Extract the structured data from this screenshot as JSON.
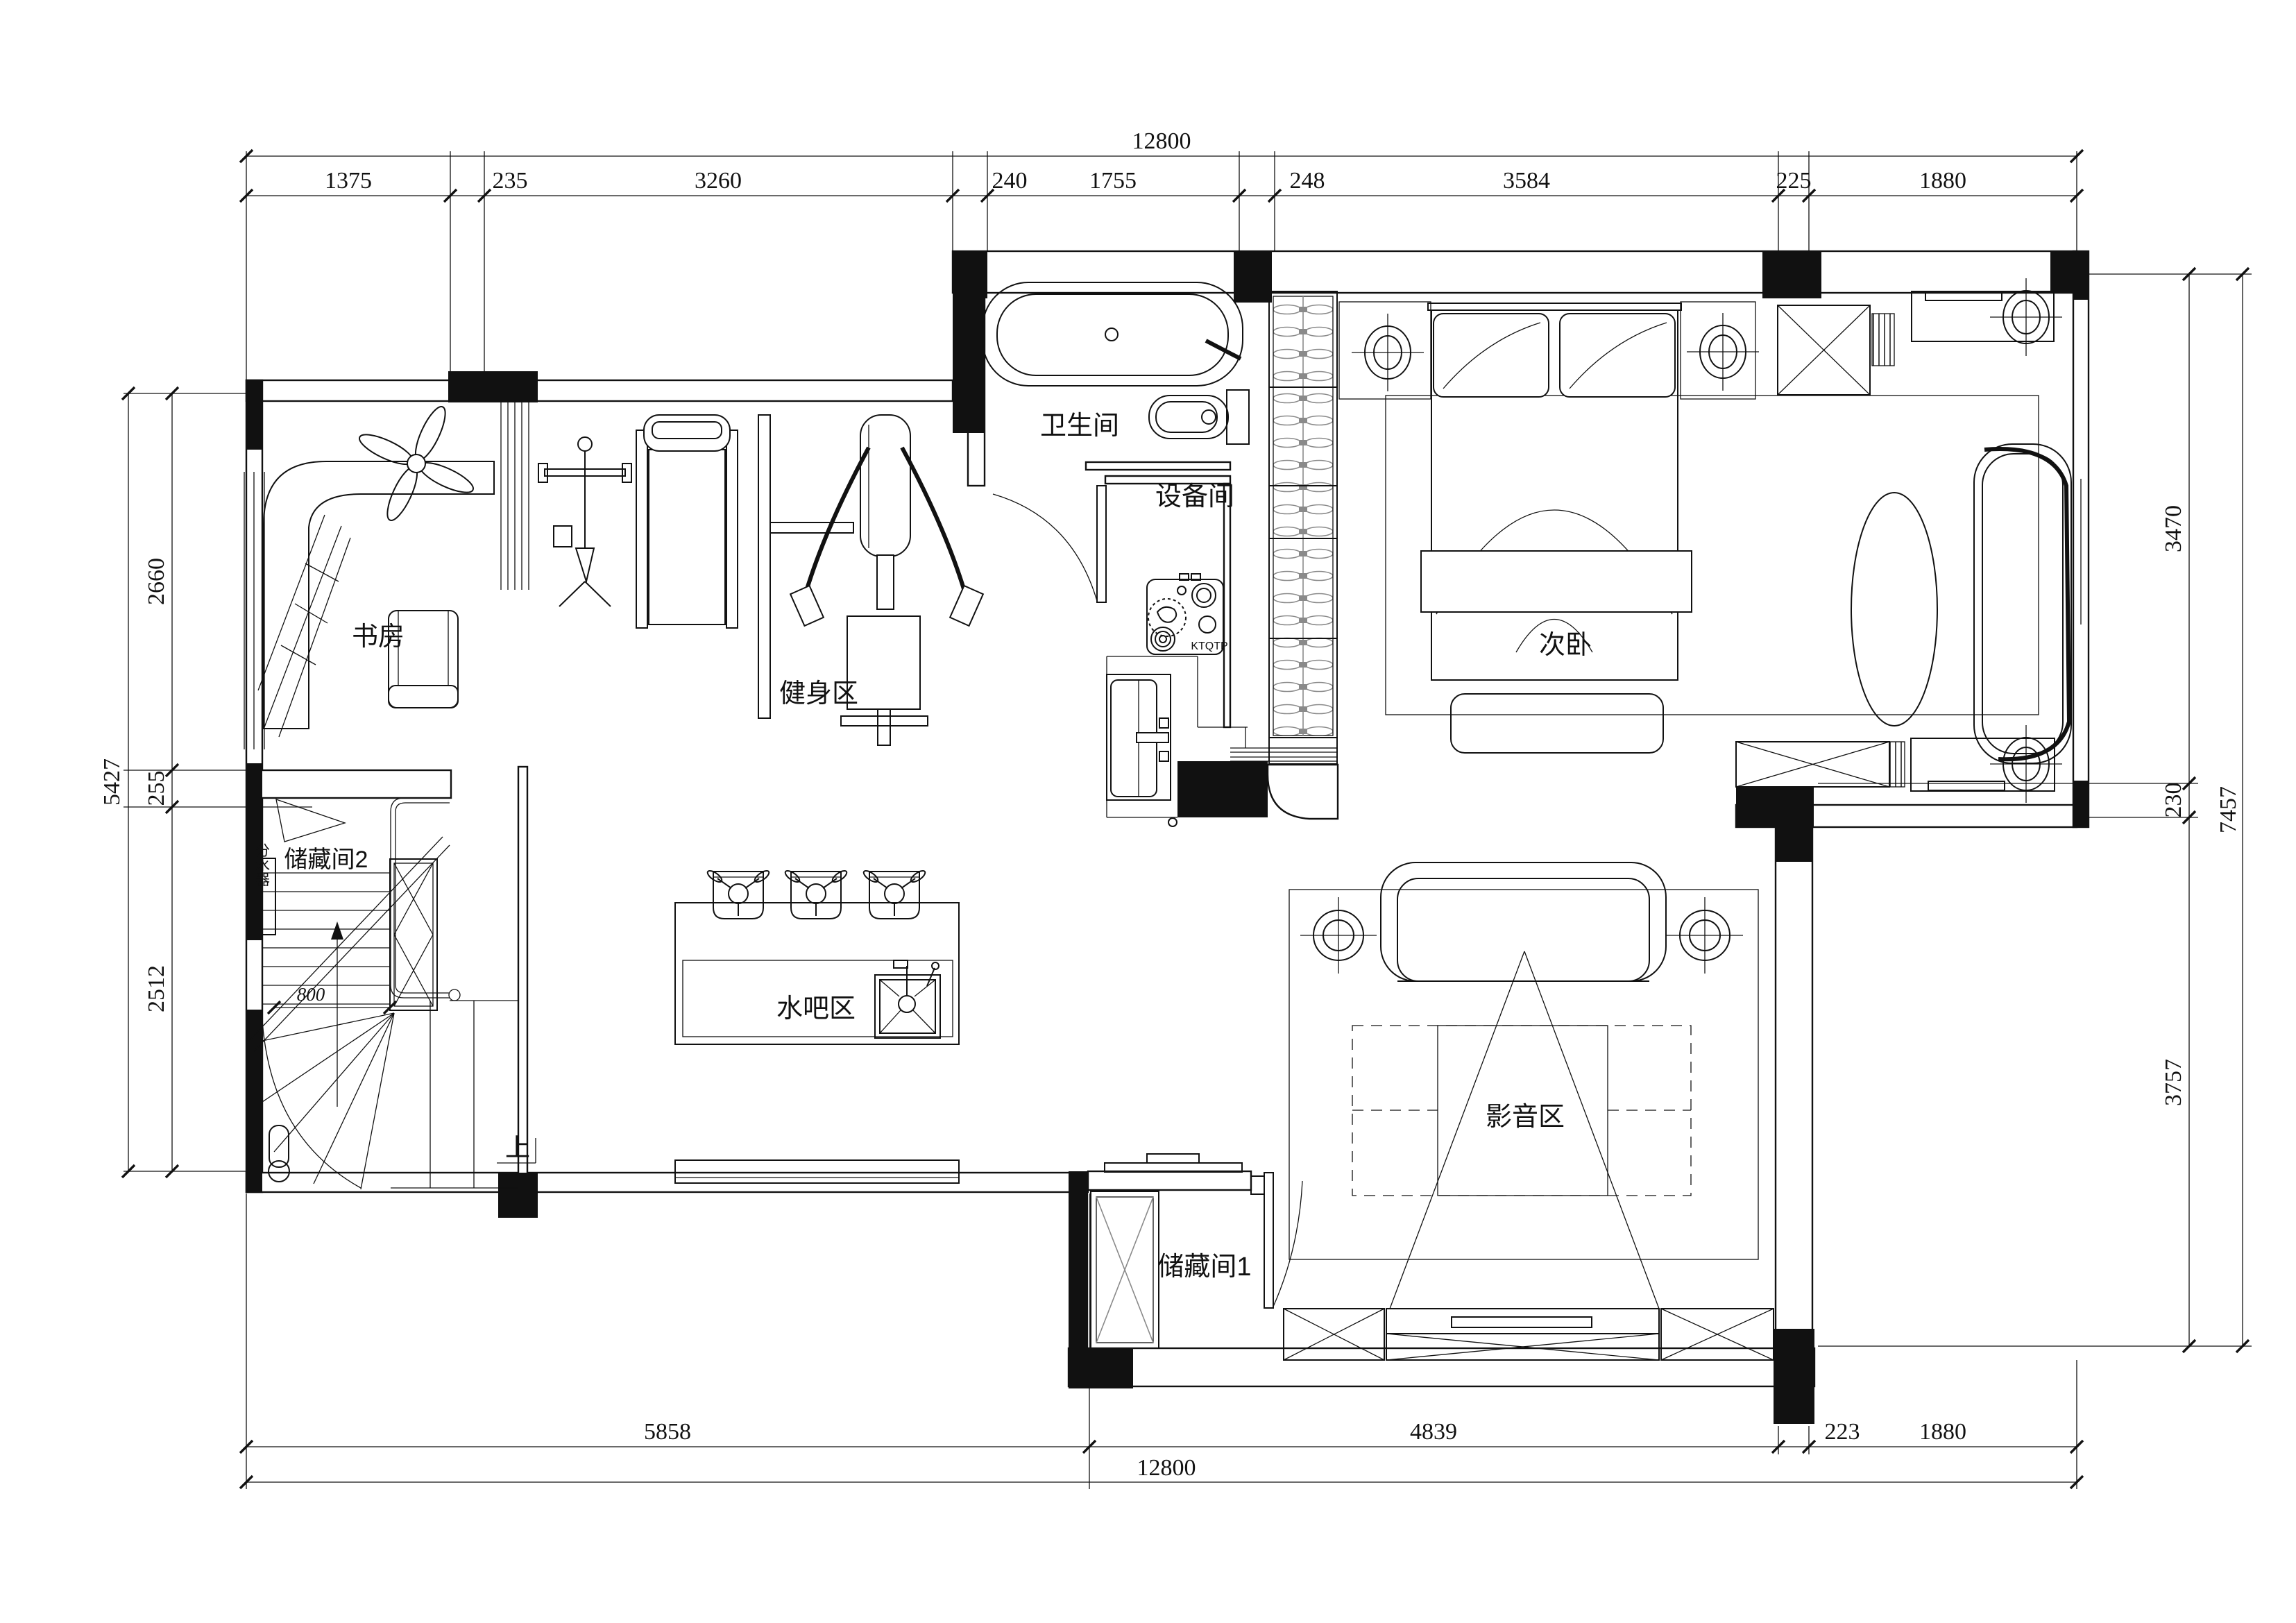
{
  "drawing": {
    "type": "residential floor plan",
    "line_color": "#111111",
    "background": "#ffffff",
    "hatch_gray": "#8a8a8a"
  },
  "dims": {
    "top": {
      "overall": "12800",
      "segments": [
        "1375",
        "235",
        "3260",
        "240",
        "1755",
        "248",
        "3584",
        "225",
        "1880"
      ]
    },
    "bottom": {
      "overall": "12800",
      "segments": [
        "5858",
        "4839",
        "223",
        "1880"
      ]
    },
    "left": {
      "overall": "5427",
      "segments": [
        "2660",
        "255",
        "2512"
      ]
    },
    "right": {
      "overall": "7457",
      "segments": [
        "3470",
        "230",
        "3757"
      ]
    }
  },
  "rooms": {
    "study": {
      "label": "书房"
    },
    "gym": {
      "label": "健身区"
    },
    "bathroom": {
      "label": "卫生间"
    },
    "equipment": {
      "label": "设备间"
    },
    "secondary_bedroom": {
      "label": "次卧"
    },
    "storage_2": {
      "label": "储藏间2"
    },
    "water_bar": {
      "label": "水吧区"
    },
    "media_zone": {
      "label": "影音区"
    },
    "storage_1": {
      "label": "储藏间1"
    }
  },
  "stairs": {
    "direction_label": "上",
    "width_label": "800"
  },
  "annotations": {
    "manifold": "分水器",
    "device_code": "KTQTP"
  }
}
